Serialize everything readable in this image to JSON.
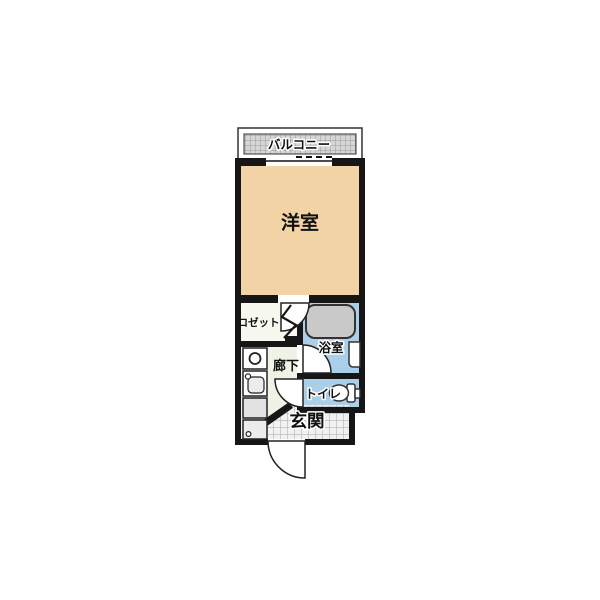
{
  "plan": {
    "rooms": {
      "balcony": "バルコニー",
      "western_room": "洋室",
      "closet": "クロゼット",
      "hallway": "廊下",
      "bathroom": "浴室",
      "toilet": "トイレ",
      "entrance": "玄関"
    },
    "colors": {
      "wall": "#161616",
      "western_room_floor": "#f2d3a6",
      "hallway_floor": "#eef3e6",
      "closet_floor": "#f7f9f0",
      "wet_floor": "#aacfe8",
      "bathtub": "#c9c9c9",
      "balcony_floor": "#d6d6d6",
      "entrance_tile": "#f1f1f1"
    },
    "fixtures": [
      "bathtub",
      "washbasin",
      "toilet",
      "stove-burner",
      "kitchen-sink",
      "counter",
      "laundry-space",
      "closet-folding-door",
      "hinged-door",
      "entrance-door",
      "sliding-window"
    ]
  }
}
